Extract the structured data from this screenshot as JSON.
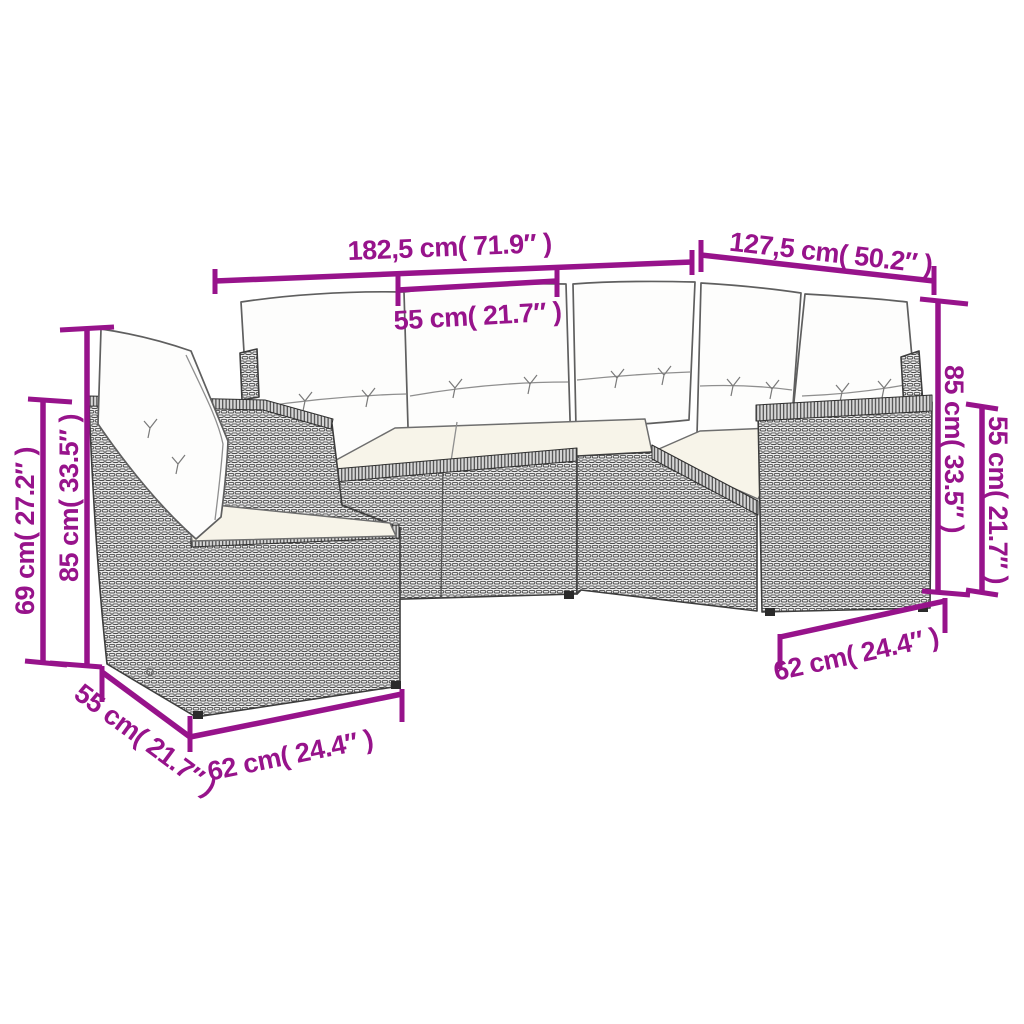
{
  "diagram": {
    "background_color": "#ffffff",
    "accent_color": "#97138B",
    "line_art_color": "#3d3d3d",
    "cushion_color": "#fdfdfc",
    "seat_cushion_color": "#f7f4e9",
    "subject": "poly rattan corner sofa set with cushions - dimension drawing"
  },
  "dimensions": {
    "top_width": {
      "label": "182,5 cm( 71.9″ )"
    },
    "top_right_depth": {
      "label": "127,5 cm( 50.2″ )"
    },
    "seat_width": {
      "label": "55 cm( 21.7″ )"
    },
    "left_total_height": {
      "label": "85 cm( 33.5″ )"
    },
    "left_back_height": {
      "label": "69 cm( 27.2″ )"
    },
    "right_total_height": {
      "label": "85 cm( 33.5″ )"
    },
    "right_arm_height": {
      "label": "55 cm( 21.7″ )"
    },
    "right_seat_depth": {
      "label": "62 cm( 24.4″ )"
    },
    "left_seat_depth": {
      "label": "62 cm( 24.4″ )"
    },
    "left_side_depth": {
      "label": "55 cm( 21.7″ )"
    }
  }
}
